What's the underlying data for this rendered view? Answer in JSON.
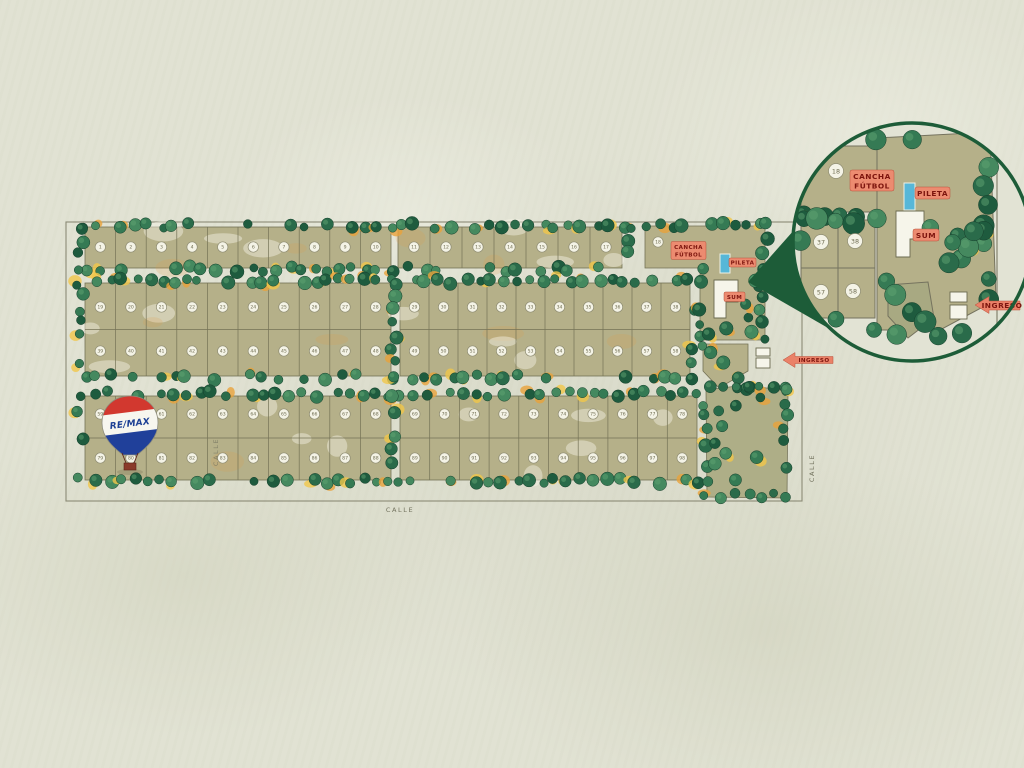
{
  "labels": {
    "calle": "CALLE",
    "cancha1": "CANCHA",
    "cancha2": "FÚTBOL",
    "pileta": "PILETA",
    "sum": "SUM",
    "ingreso": "INGRESO",
    "remax": "RE/MAX"
  },
  "colors": {
    "paper": "#e2e3d4",
    "lot": "#b5b089",
    "lotLine": "#747256",
    "boundary": "#8b8a76",
    "treeStroke": "#17402c",
    "treePalette": [
      "#1e5b3e",
      "#2a6b4a",
      "#357a54",
      "#45895f"
    ],
    "orange": "#e8a23b",
    "yellow": "#f1c74a",
    "labelBg": "#ec8b70",
    "labelText": "#7d150e",
    "pool": "#57b7d8",
    "building": "#f6f5ea",
    "insetGreen": "#1d5c38",
    "remaxRed": "#d2382f",
    "remaxBlue": "#20409a",
    "numberCircle": "#f4f3e6",
    "numberText": "#6f6d52"
  },
  "map": {
    "boundary": {
      "x": 66,
      "y": 222,
      "w": 736,
      "h": 279
    },
    "blocks": [
      {
        "id": "top-left",
        "x": 85,
        "y": 227,
        "w": 306,
        "h": 41,
        "rows": [
          {
            "cy": 247,
            "nums": [
              "1",
              "2",
              "3",
              "4",
              "5",
              "6",
              "7",
              "8",
              "9",
              "10"
            ]
          }
        ]
      },
      {
        "id": "top-right",
        "x": 398,
        "y": 227,
        "w": 224,
        "h": 41,
        "rows": [
          {
            "cy": 247,
            "nums": [
              "11",
              "12",
              "13",
              "14",
              "15",
              "16",
              "17"
            ]
          }
        ]
      },
      {
        "id": "mid-left",
        "x": 85,
        "y": 283,
        "w": 306,
        "h": 93,
        "rows": [
          {
            "cy": 307,
            "nums": [
              "19",
              "20",
              "21",
              "22",
              "23",
              "24",
              "25",
              "26",
              "27",
              "28"
            ]
          },
          {
            "cy": 351,
            "nums": [
              "39",
              "40",
              "41",
              "42",
              "43",
              "44",
              "45",
              "46",
              "47",
              "48"
            ]
          }
        ]
      },
      {
        "id": "mid-right",
        "x": 400,
        "y": 283,
        "w": 290,
        "h": 93,
        "rows": [
          {
            "cy": 307,
            "nums": [
              "29",
              "30",
              "31",
              "32",
              "33",
              "34",
              "35",
              "36",
              "37",
              "38"
            ]
          },
          {
            "cy": 351,
            "nums": [
              "49",
              "50",
              "51",
              "52",
              "53",
              "54",
              "55",
              "56",
              "57",
              "58"
            ]
          }
        ]
      },
      {
        "id": "bottom-left",
        "x": 85,
        "y": 396,
        "w": 306,
        "h": 84,
        "rows": [
          {
            "cy": 414,
            "nums": [
              "59",
              "60",
              "61",
              "62",
              "63",
              "64",
              "65",
              "66",
              "67",
              "68"
            ]
          },
          {
            "cy": 458,
            "nums": [
              "79",
              "80",
              "81",
              "82",
              "83",
              "84",
              "85",
              "86",
              "87",
              "88"
            ]
          }
        ]
      },
      {
        "id": "bottom-right",
        "x": 400,
        "y": 396,
        "w": 297,
        "h": 84,
        "rows": [
          {
            "cy": 414,
            "nums": [
              "69",
              "70",
              "71",
              "72",
              "73",
              "74",
              "75",
              "76",
              "77",
              "78"
            ]
          },
          {
            "cy": 458,
            "nums": [
              "89",
              "90",
              "91",
              "92",
              "93",
              "94",
              "95",
              "96",
              "97",
              "98"
            ]
          }
        ]
      }
    ],
    "corner_lot": {
      "x": 658,
      "y": 242,
      "num": "18"
    }
  },
  "inset": {
    "cx": 912,
    "cy": 242,
    "r": 119,
    "lots": [
      {
        "x": 836,
        "y": 171,
        "num": "18"
      },
      {
        "x": 821,
        "y": 242,
        "num": "37"
      },
      {
        "x": 855,
        "y": 241,
        "num": "38"
      },
      {
        "x": 821,
        "y": 292,
        "num": "57"
      },
      {
        "x": 853,
        "y": 291,
        "num": "58"
      }
    ]
  }
}
